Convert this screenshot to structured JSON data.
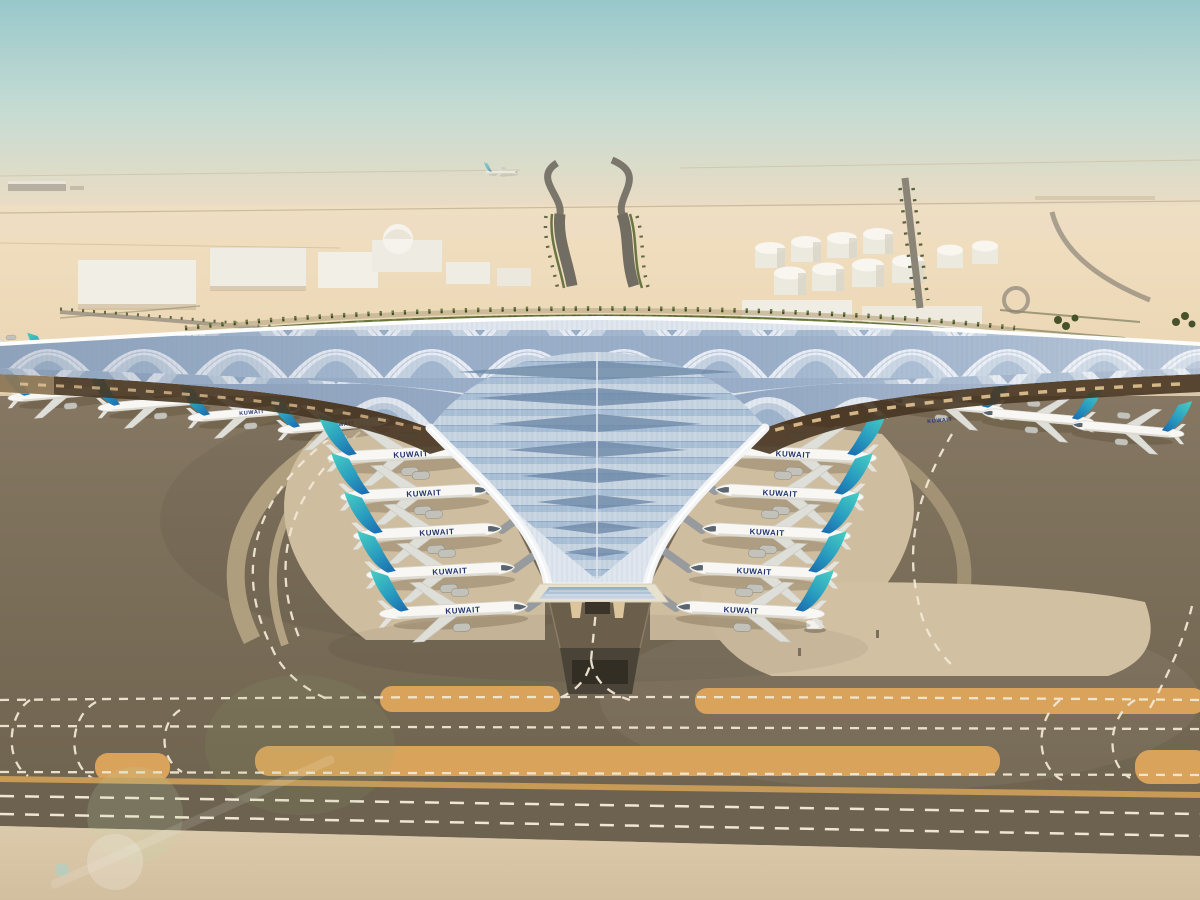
{
  "meta": {
    "title": "Aerial daytime rendering of Kuwait International Airport new trident-shaped terminal",
    "domain_kind": "architectural render, no UI chrome"
  },
  "scene": {
    "airline": "KUWAIT",
    "aircraft": {
      "count_drawn": 22,
      "fuselage": "#f8f7f3",
      "tail_teal": "#49cfc3",
      "tail_mid": "#2a9fc0",
      "tail_blue": "#1b6cb0",
      "text_color": "#21356e"
    },
    "sky": {
      "top": "#98c8cb",
      "mid": "#c7dcd3",
      "haze": "#e6dcc5",
      "horizon": "#efe0c6"
    },
    "desert": {
      "far": "#f0dfc2",
      "mid": "#e9d2ab",
      "near": "#dfc79f"
    },
    "terminal": {
      "roof_base": "#dfe6ee",
      "shell_blue": "#93a9c5",
      "shell_silver": "#e9edf4",
      "valley_light": "#c7d4e2",
      "valley_blue": "#a9bfd6",
      "edge_white": "#f2f4f6",
      "underside": "#473522",
      "arch_tan": "#d9ba8c",
      "facade_frame": "#e8e1ce",
      "glass": "#93acc8"
    },
    "ground": {
      "asphalt_top": "#857762",
      "asphalt_bottom": "#6f644f",
      "apron_cream": "#d9c7a9",
      "stand_cream": "#cfbd9f",
      "island_cream": "#d2c0a2",
      "strip_orange": "#d9a35c",
      "marking": "#f1e8d4",
      "road_bottom": "#6d6250",
      "road_border": "#c79a57"
    },
    "landscape": {
      "green_belt": "#66743a",
      "palm_dark": "#3e4b24",
      "palm_light": "#6d7c3f",
      "building_white": "#f1eee6",
      "tank_white": "#f4f1ea",
      "road_gray": "#8b8577"
    }
  }
}
